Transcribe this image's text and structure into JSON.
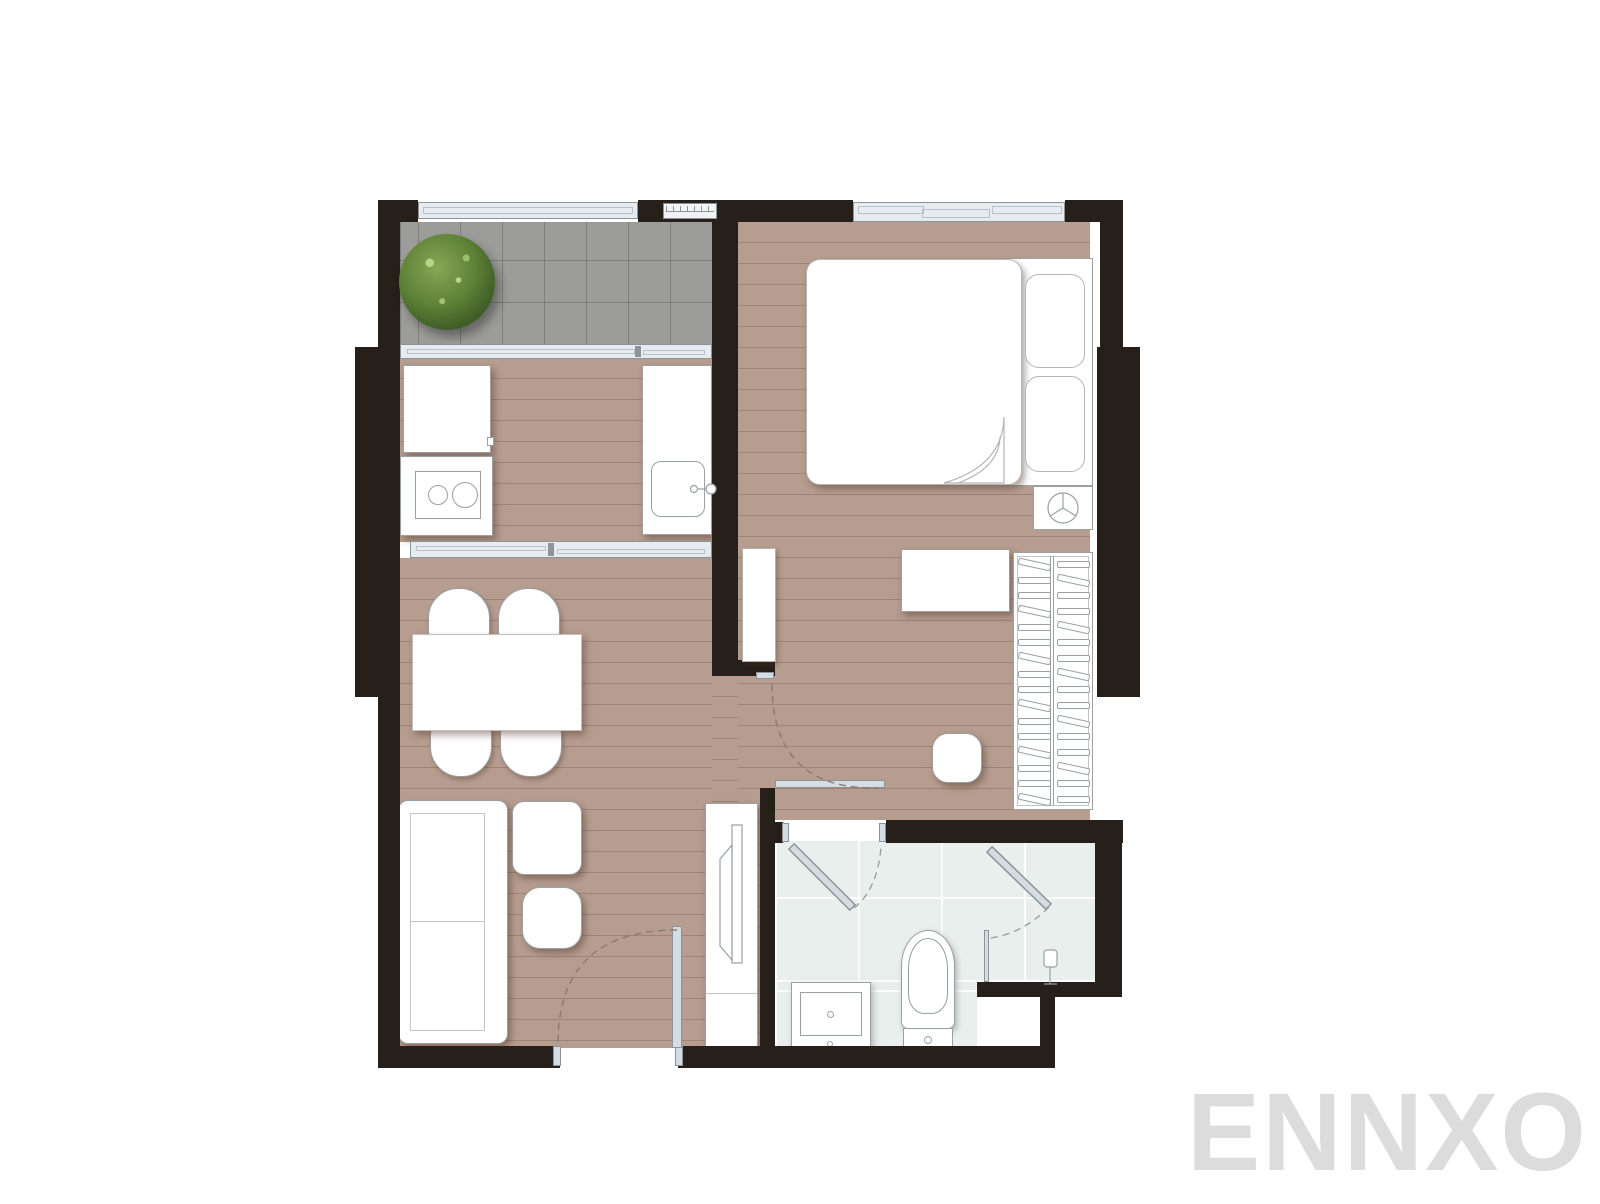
{
  "watermark": {
    "text": "ENNXO"
  },
  "colors": {
    "wall": "#261f1a",
    "wood": "#b69d8f",
    "wood_line": "rgba(100,65,45,0.28)",
    "tile": "#9c9c9a",
    "tile_line": "rgba(40,40,40,0.25)",
    "bath": "#e9efed",
    "bath_grout": "#fbfdfc",
    "window_fill": "#e6ebef",
    "window_edge": "#8b949b",
    "leaf_fill": "#d5dde2",
    "outline": "#9aa0a4",
    "dash_wood": "#8a7b70",
    "dash_tile": "#98a0a0",
    "plant_hi": "#86a854",
    "plant_mid": "#5d8136",
    "plant_dark": "#33501f",
    "watermark": "#dcdcdc"
  },
  "metrics": {
    "balcony_tile": "42",
    "bath_tile": "83",
    "wardrobe_hanger_rows": "16",
    "stove_burners": "2",
    "dining_chairs": "4",
    "bed_pillows": "2",
    "bedroom_window_panes": "3"
  }
}
